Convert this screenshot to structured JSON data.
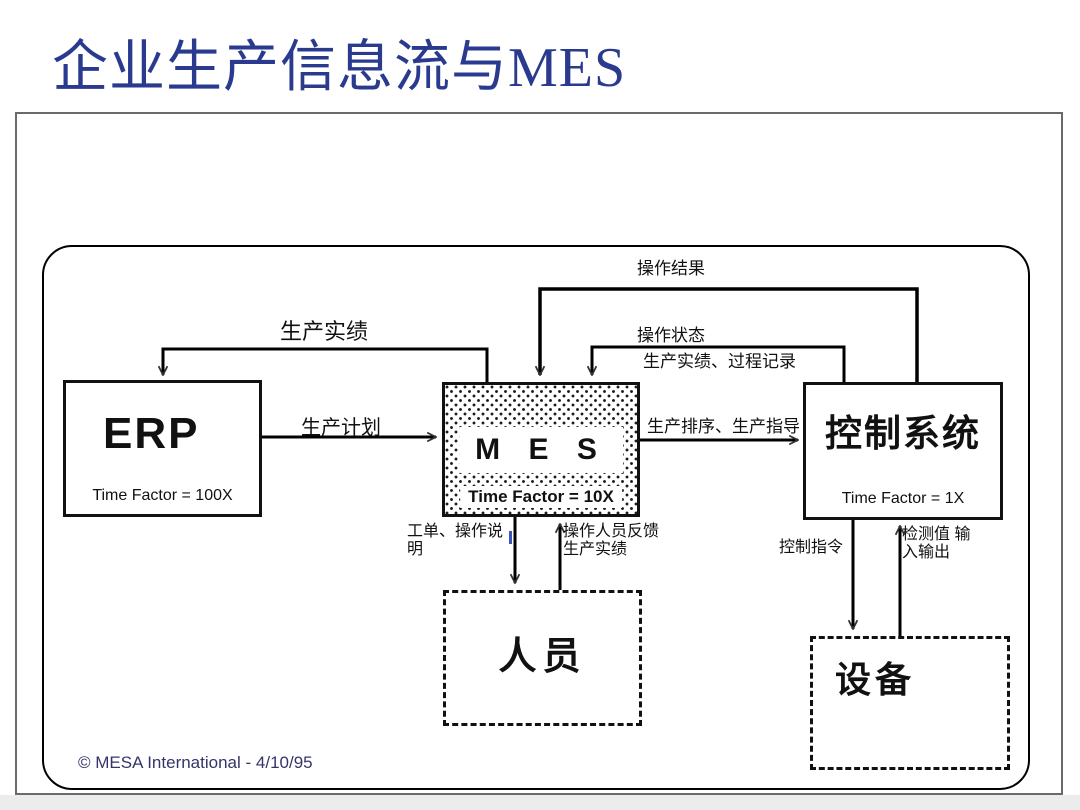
{
  "title": "企业生产信息流与MES",
  "boxes": {
    "erp": {
      "label": "ERP",
      "time_factor": "Time Factor = 100X"
    },
    "mes": {
      "label": "M E S",
      "time_factor": "Time Factor = 10X"
    },
    "control_system": {
      "label": "控制系统",
      "time_factor": "Time Factor = 1X"
    },
    "personnel": {
      "label": "人员"
    },
    "equipment": {
      "label": "设备"
    }
  },
  "flows": {
    "production_actuals": "生产实绩",
    "production_plan": "生产计划",
    "operation_results": "操作结果",
    "operation_status": "操作状态",
    "actuals_process_records": "生产实绩、过程记录",
    "dispatch_guidance": "生产排序、生产指导",
    "work_orders": "工单、操作说明",
    "operator_feedback": "操作人员反馈 生产实绩",
    "control_commands": "控制指令",
    "measured_io": "检测值 输入输出"
  },
  "footer": {
    "copyright": "© MESA International - 4/10/95"
  },
  "colors": {
    "title_blue": "#2a3b8f",
    "line_black": "#000000",
    "copyright_navy": "#34346a",
    "frame_gray": "#6a6a6a"
  }
}
